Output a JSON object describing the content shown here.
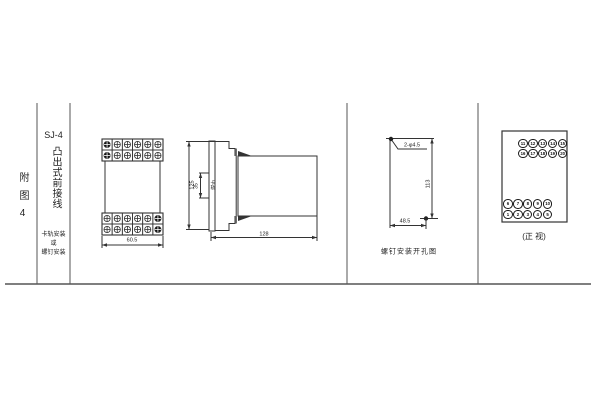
{
  "figure_label": "附图4",
  "model_column": {
    "model": "SJ-4",
    "wiring_type": "凸出式前接线",
    "mount_lines": [
      "卡轨安装",
      "或",
      "螺钉安装"
    ]
  },
  "front_view": {
    "width_dim": "60.5"
  },
  "side_view": {
    "height_dim": "125",
    "rail_dim": "35",
    "rail_label": "卡轨",
    "depth_dim": "128"
  },
  "drill_view": {
    "holes_label": "2-φ4.5",
    "vertical_dim": "113",
    "horizontal_dim": "48.5",
    "caption": "螺钉安装开孔图"
  },
  "terminal_view": {
    "caption": "(正 视)",
    "top_rows": [
      [
        "11",
        "12",
        "13",
        "14",
        "15"
      ],
      [
        "16",
        "17",
        "18",
        "19",
        "20"
      ]
    ],
    "bottom_rows": [
      [
        "6",
        "7",
        "8",
        "9",
        "10"
      ],
      [
        "1",
        "2",
        "3",
        "4",
        "5"
      ]
    ]
  },
  "colors": {
    "line": "#333333",
    "text": "#222222",
    "background": "#ffffff"
  }
}
